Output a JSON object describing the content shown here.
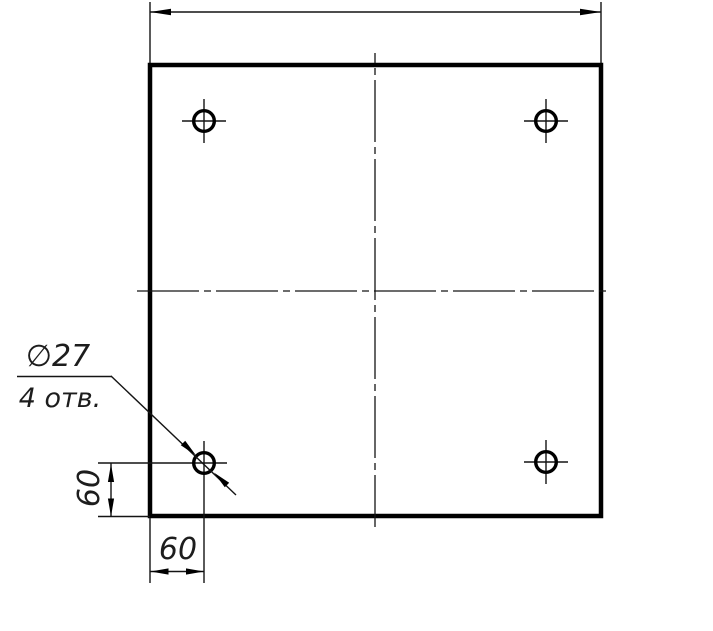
{
  "drawing": {
    "kind": "plate-with-four-holes",
    "callout": {
      "diameter": "∅27",
      "count": "4 отв."
    },
    "dims": {
      "offset_x": "60",
      "offset_y": "60"
    },
    "colors": {
      "background": "#ffffff",
      "line": "#000000",
      "thin_line": "#141414",
      "text": "#1d1d1d"
    }
  }
}
